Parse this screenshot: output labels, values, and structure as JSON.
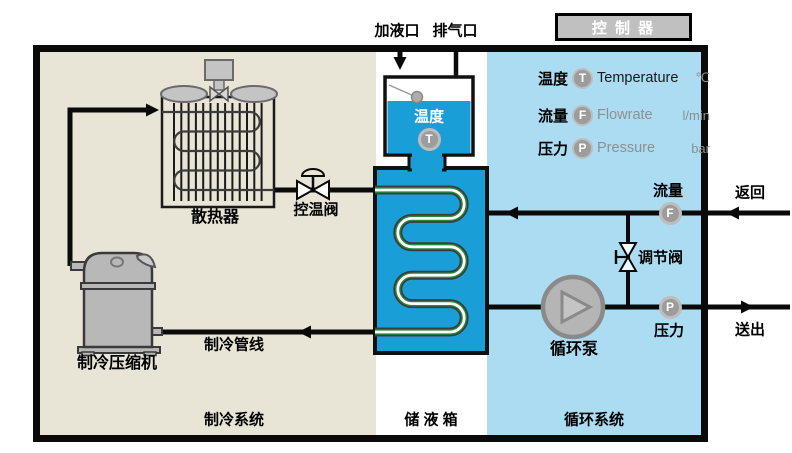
{
  "header": {
    "controller_label": "控 制 器",
    "fill_port_label": "加液口",
    "vent_port_label": "排气口"
  },
  "legend": {
    "rows": [
      {
        "zh": "温度",
        "symbol": "T",
        "en": "Temperature",
        "unit": "℃"
      },
      {
        "zh": "流量",
        "symbol": "F",
        "en": "Flowrate",
        "unit": "l/min"
      },
      {
        "zh": "压力",
        "symbol": "P",
        "en": "Pressure",
        "unit": "bar"
      }
    ]
  },
  "zones": [
    {
      "id": "refrigeration",
      "label": "制冷系统"
    },
    {
      "id": "storage-tank",
      "label": "储 液 箱"
    },
    {
      "id": "circulation",
      "label": "循环系统"
    }
  ],
  "components": {
    "radiator_label": "散热器",
    "temp_control_valve_label": "控温阀",
    "compressor_label": "制冷压缩机",
    "refrigerant_line_label": "制冷管线",
    "tank_sensor_label": "温度",
    "tank_sensor_symbol": "T",
    "pump_label": "循环泵",
    "regulating_valve_label": "调节阀",
    "flow_sensor_label": "流量",
    "flow_sensor_symbol": "F",
    "pressure_sensor_label": "压力",
    "pressure_sensor_symbol": "P"
  },
  "ports": {
    "return_label": "返回",
    "supply_label": "送出"
  },
  "colors": {
    "refrigeration_zone_bg": "#e8e5d6",
    "circulation_zone_bg": "#abdcf2",
    "tank_fill": "#1a9ed8",
    "coil_green": "#238b3b",
    "component_gray": "#bdbdbd",
    "controller_bg": "#c0c0c0",
    "pipe": "#0a0a0a"
  }
}
